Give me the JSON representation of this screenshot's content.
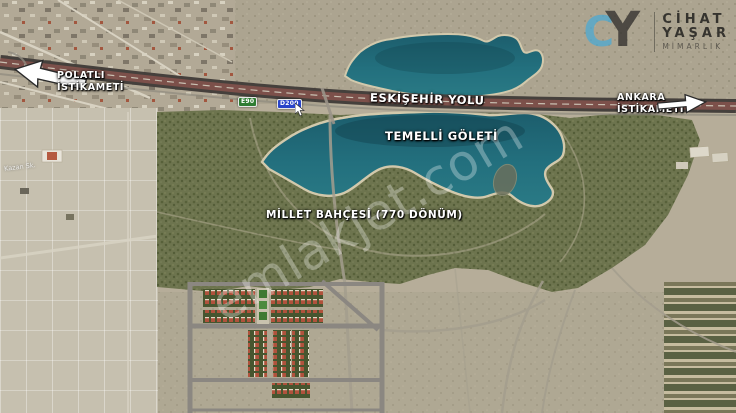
{
  "map": {
    "labels": {
      "road": "ESKİŞEHİR YOLU",
      "lake": "TEMELLİ GÖLETİ",
      "park": "MİLLET BAHÇESİ (770 DÖNÜM)",
      "polatli_line1": "POLATLI",
      "polatli_line2": "İSTİKAMETİ",
      "ankara_line1": "ANKARA",
      "ankara_line2": "İSTİKAMETİ",
      "street_faint": "Kazan Sk."
    },
    "road_signs": {
      "e_route": "E90",
      "d_road": "D200"
    }
  },
  "logo": {
    "monogram_c": "C",
    "monogram_y": "Y",
    "name_line1": "CİHAT",
    "name_line2": "YAŞAR",
    "name_line3": "MİMARLIK"
  },
  "watermark": {
    "text": "emlakjet.com"
  },
  "colors": {
    "lake_teal": "#206a78",
    "park_green": "#6d744e",
    "land_tan": "#b6ad99",
    "highway_dark": "#45403c",
    "highway_lanes": "#7c504a",
    "sign_green": "#2f7d33",
    "sign_blue": "#2944c9",
    "logo_blue": "#4aa9d4",
    "roof_red": "#b0523c",
    "label_text": "#ffffff"
  }
}
